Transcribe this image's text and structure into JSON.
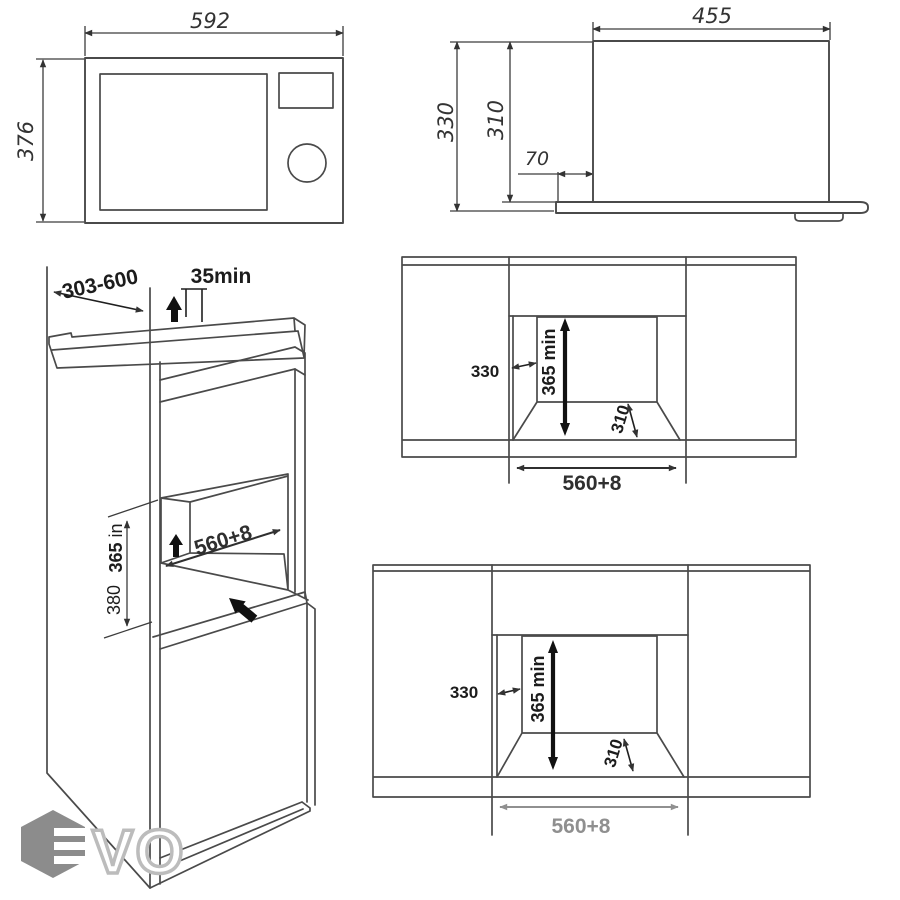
{
  "views": {
    "front": {
      "width": "592",
      "height": "376"
    },
    "side": {
      "width": "455",
      "height_total": "330",
      "height_body": "310",
      "plate_offset": "70"
    },
    "cabinet": {
      "depth_range": "303-600",
      "top_clearance": "35min",
      "niche_width": "560+8",
      "niche_height": "365",
      "niche_height_unit": " in",
      "niche_height_alt": "380"
    },
    "niche_mid": {
      "depth": "330",
      "height": "365",
      "height_unit": " min",
      "side": "310",
      "width": "560+8"
    },
    "niche_bottom": {
      "depth": "330",
      "height": "365",
      "height_unit": " min",
      "side": "310",
      "width": "560+8"
    }
  },
  "watermark": {
    "letters": "VO"
  },
  "colors": {
    "line": "#4a4a4a",
    "label": "#1c1c1c",
    "muted_label": "#8f8f8f",
    "watermark_hex": "#8c8c8c",
    "watermark_letter": "#bcbcbc"
  }
}
